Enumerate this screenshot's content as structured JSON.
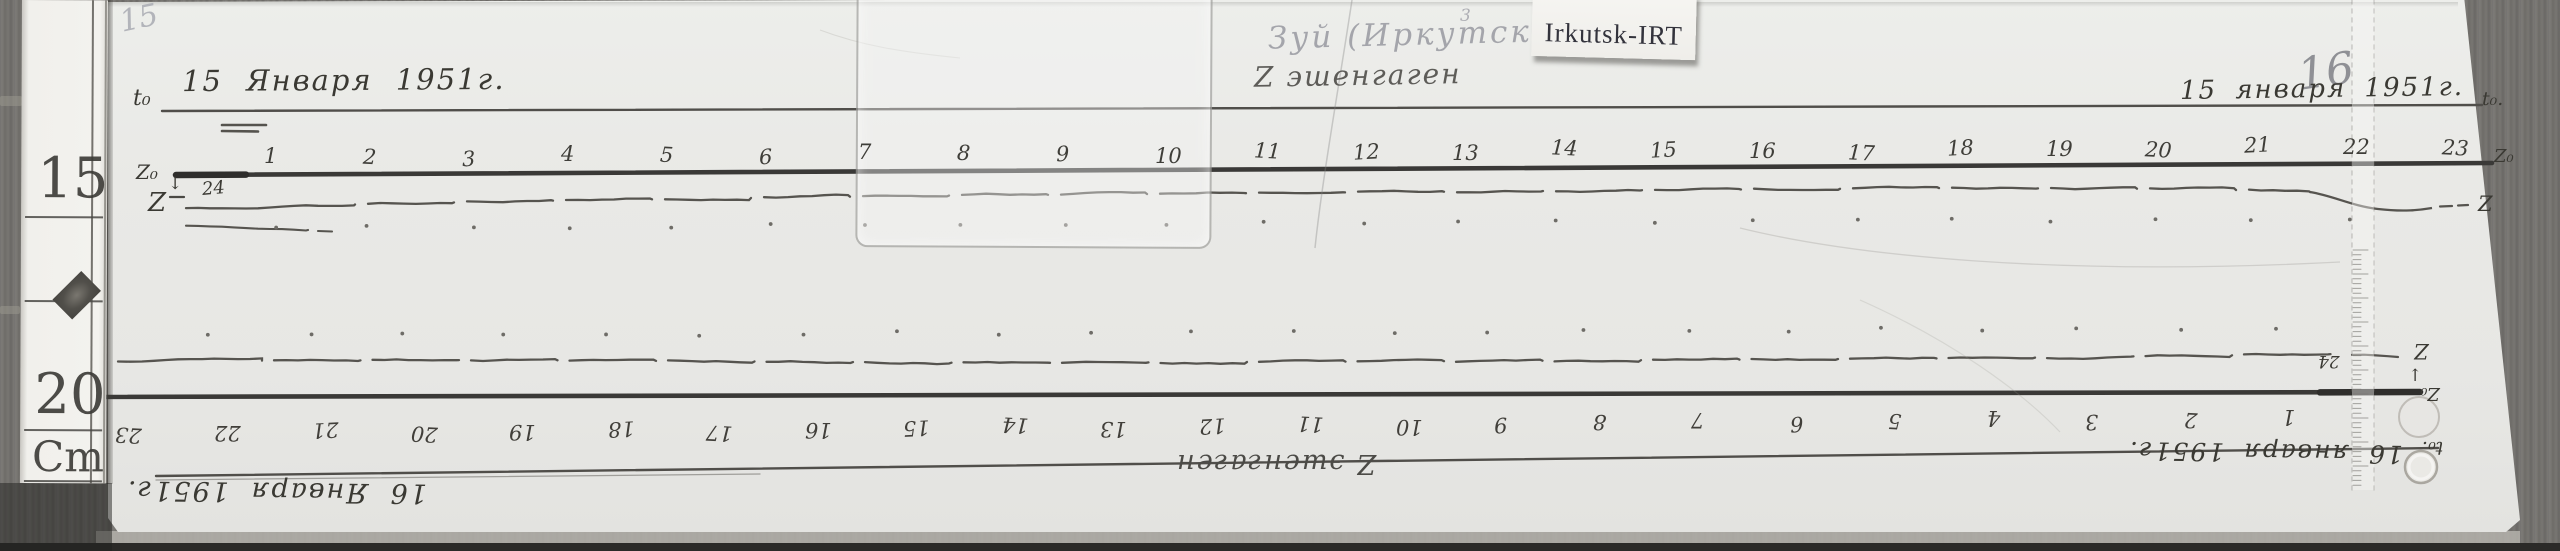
{
  "page": {
    "left_page_number": "15",
    "right_page_number": "16"
  },
  "tag": {
    "label": "Irkutsk-IRT"
  },
  "station_note": {
    "name": "Зуй (Иркутск)",
    "superscript": "3",
    "instrument": "Z эшенгаген"
  },
  "left_ruler": {
    "mark_15": "15",
    "mark_20": "20",
    "unit": "Cm"
  },
  "top_record": {
    "t0_label_left": "t₀",
    "date_left": "15 Января 1951г.",
    "date_right": "15 января 1951г.",
    "t0_label_right": "t₀.",
    "z0_label_left": "Z₀",
    "z0_arrow": "↓",
    "z_label_left": "Z",
    "start_hour_note": "24",
    "z0_label_right": "Z₀",
    "z_label_right": "Z",
    "hours": [
      "1",
      "2",
      "3",
      "4",
      "5",
      "6",
      "7",
      "8",
      "9",
      "10",
      "11",
      "12",
      "13",
      "14",
      "15",
      "16",
      "17",
      "18",
      "19",
      "20",
      "21",
      "22",
      "23"
    ]
  },
  "bottom_record": {
    "t0_label_right": "t₀.",
    "date_right": "16 января 1951г.",
    "date_left": "16 Января 1951г.",
    "instrument": "Z эшенгаген",
    "z0_label_right": "Z₀",
    "z0_arrow": "↑",
    "z_label_right": "Z",
    "start_hour_note": "24",
    "hours": [
      "1",
      "2",
      "3",
      "4",
      "5",
      "6",
      "7",
      "8",
      "9",
      "10",
      "11",
      "12",
      "13",
      "14",
      "15",
      "16",
      "17",
      "18",
      "19",
      "20",
      "21",
      "22",
      "23"
    ]
  },
  "colors": {
    "paper": "#e9e9e6",
    "wood": "#747270",
    "ink": "#3a3933",
    "trace": "#56544f",
    "faded_note": "#a4a5ab",
    "pencil": "#9a9ba0",
    "tag_background": "#f5f4f1"
  }
}
